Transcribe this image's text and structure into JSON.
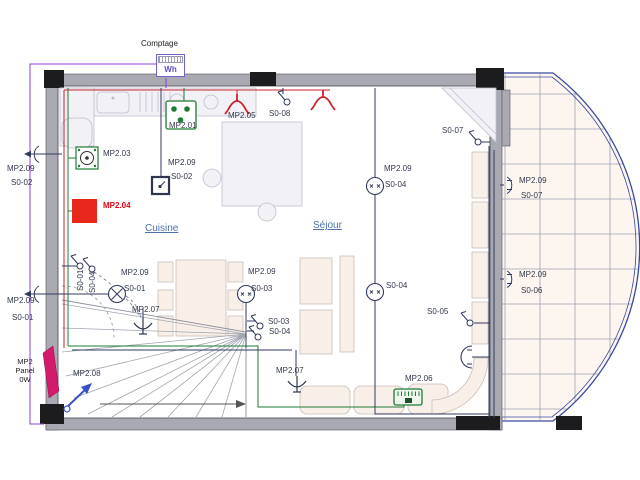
{
  "meter": {
    "title": "Comptage",
    "unit": "Wh"
  },
  "rooms": {
    "kitchen": "Cuisine",
    "living": "Séjour"
  },
  "panel": {
    "line1": "MP2",
    "line2": "Panel",
    "line3": "0W"
  },
  "colors": {
    "wire_red": "#cc2229",
    "wire_green": "#1f7a33",
    "wire_violet": "#8a3fd6",
    "wire_navy": "#303a5c",
    "terrace_blue": "#39499e",
    "panel_magenta": "#d41a6b",
    "room_label_blue": "#4d71a8",
    "alert_red": "#e30613"
  },
  "device_labels": [
    {
      "text": "MP2.01",
      "x": 169,
      "y": 121
    },
    {
      "text": "MP2.05",
      "x": 228,
      "y": 111
    },
    {
      "text": "S0-08",
      "x": 269,
      "y": 109
    },
    {
      "text": "MP2.03",
      "x": 103,
      "y": 149
    },
    {
      "text": "MP2.09",
      "x": 168,
      "y": 158
    },
    {
      "text": "S0-02",
      "x": 171,
      "y": 172
    },
    {
      "text": "MP2.04",
      "x": 103,
      "y": 201,
      "color": "#e30613",
      "bold": true
    },
    {
      "text": "MP2.09",
      "x": 7,
      "y": 164
    },
    {
      "text": "S0-02",
      "x": 11,
      "y": 178
    },
    {
      "text": "MP2.09",
      "x": 7,
      "y": 296
    },
    {
      "text": "S0-01",
      "x": 12,
      "y": 313
    },
    {
      "text": "MP2.09",
      "x": 384,
      "y": 164
    },
    {
      "text": "S0-04",
      "x": 385,
      "y": 180
    },
    {
      "text": "S0-07",
      "x": 442,
      "y": 126
    },
    {
      "text": "MP2.09",
      "x": 519,
      "y": 176
    },
    {
      "text": "S0-07",
      "x": 521,
      "y": 191
    },
    {
      "text": "MP2.09",
      "x": 519,
      "y": 270
    },
    {
      "text": "S0-06",
      "x": 521,
      "y": 286
    },
    {
      "text": "MP2.09",
      "x": 121,
      "y": 268
    },
    {
      "text": "S0-01",
      "x": 124,
      "y": 284
    },
    {
      "text": "S0-01",
      "x": 76,
      "y": 291,
      "rot": -90
    },
    {
      "text": "S0-04",
      "x": 88,
      "y": 293,
      "rot": -90
    },
    {
      "text": "MP2.07",
      "x": 132,
      "y": 305
    },
    {
      "text": "MP2.09",
      "x": 248,
      "y": 267
    },
    {
      "text": "S0-03",
      "x": 251,
      "y": 284
    },
    {
      "text": "S0-03",
      "x": 268,
      "y": 317
    },
    {
      "text": "S0-04",
      "x": 269,
      "y": 327
    },
    {
      "text": "MP2.07",
      "x": 276,
      "y": 366
    },
    {
      "text": "MP2.06",
      "x": 405,
      "y": 374
    },
    {
      "text": "S0-05",
      "x": 427,
      "y": 307
    },
    {
      "text": "S0-04",
      "x": 386,
      "y": 281
    },
    {
      "text": "MP2.08",
      "x": 73,
      "y": 369
    }
  ],
  "symbols": [
    {
      "type": "socket-outlet",
      "x": 166,
      "y": 101
    },
    {
      "type": "lamp-red",
      "x": 226,
      "y": 97
    },
    {
      "type": "lamp-red",
      "x": 312,
      "y": 93
    },
    {
      "type": "switch",
      "x": 277,
      "y": 90
    },
    {
      "type": "hob-socket",
      "x": 76,
      "y": 147
    },
    {
      "type": "red-square",
      "x": 72,
      "y": 199
    },
    {
      "type": "switch-box",
      "x": 152,
      "y": 177
    },
    {
      "type": "wall-lamp-left",
      "x": 24,
      "y": 145
    },
    {
      "type": "wall-lamp-left",
      "x": 24,
      "y": 285
    },
    {
      "type": "lamp-x",
      "x": 108,
      "y": 285
    },
    {
      "type": "switch",
      "x": 70,
      "y": 254
    },
    {
      "type": "switch",
      "x": 82,
      "y": 257
    },
    {
      "type": "lamp-circle",
      "x": 237,
      "y": 285
    },
    {
      "type": "switch",
      "x": 250,
      "y": 314
    },
    {
      "type": "switch",
      "x": 248,
      "y": 325
    },
    {
      "type": "y-lamp",
      "x": 133,
      "y": 318
    },
    {
      "type": "y-lamp",
      "x": 287,
      "y": 376
    },
    {
      "type": "terminal",
      "x": 394,
      "y": 389
    },
    {
      "type": "lamp-circle",
      "x": 366,
      "y": 177
    },
    {
      "type": "lamp-circle",
      "x": 366,
      "y": 283
    },
    {
      "type": "switch",
      "x": 468,
      "y": 130
    },
    {
      "type": "switch",
      "x": 460,
      "y": 311
    },
    {
      "type": "wall-lamp-right",
      "x": 504,
      "y": 176
    },
    {
      "type": "wall-lamp-right",
      "x": 504,
      "y": 270
    },
    {
      "type": "wall-lamp-inner",
      "x": 452,
      "y": 346
    },
    {
      "type": "panel",
      "x": 42,
      "y": 346
    },
    {
      "type": "stair-lamp",
      "x": 64,
      "y": 378
    }
  ]
}
